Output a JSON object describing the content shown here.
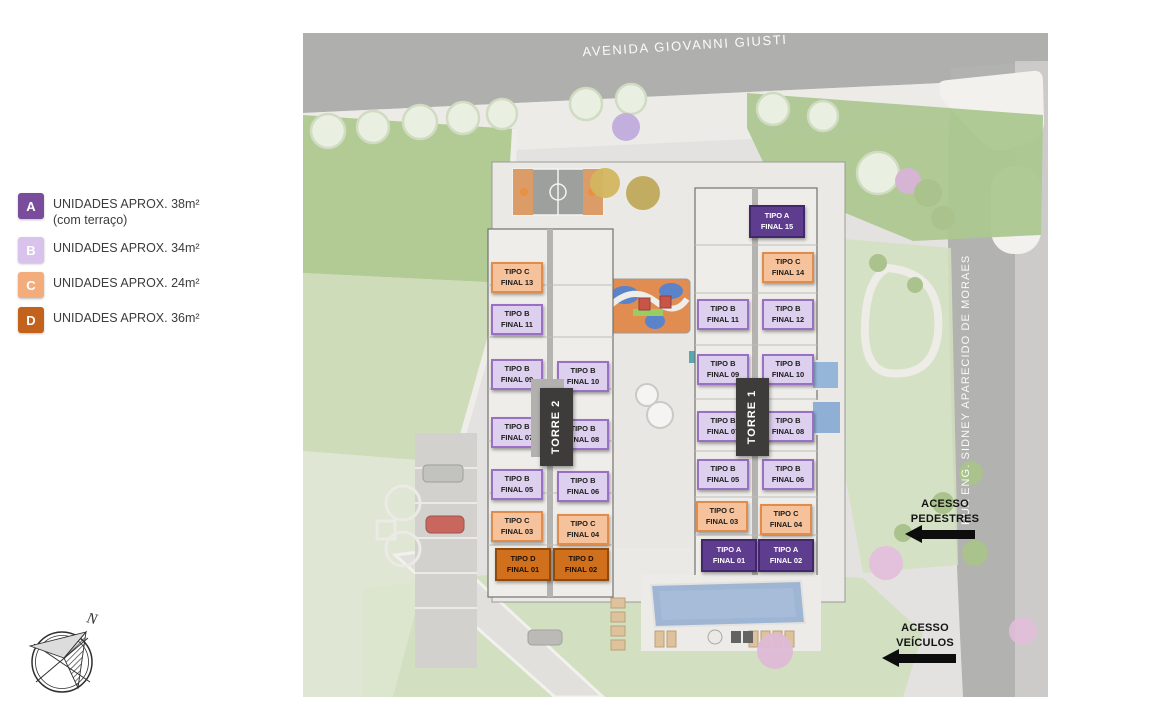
{
  "legend": {
    "items": [
      {
        "code": "A",
        "label": "UNIDADES APROX. 38m²",
        "sublabel": "(com terraço)",
        "color": "#7a4d9c"
      },
      {
        "code": "B",
        "label": "UNIDADES APROX. 34m²",
        "sublabel": "",
        "color": "#d9c2ec"
      },
      {
        "code": "C",
        "label": "UNIDADES APROX. 24m²",
        "sublabel": "",
        "color": "#f3ad7d"
      },
      {
        "code": "D",
        "label": "UNIDADES APROX. 36m²",
        "sublabel": "",
        "color": "#c2621c"
      }
    ]
  },
  "streets": {
    "top": "AVENIDA GIOVANNI GIUSTI",
    "right": "RUA ENG. SIDNEY APARECIDO DE MORAES"
  },
  "towers": {
    "torre2": "TORRE 2",
    "torre1": "TORRE 1"
  },
  "access": {
    "pedestrians": {
      "line1": "ACESSO",
      "line2": "PEDESTRES"
    },
    "vehicles": {
      "line1": "ACESSO",
      "line2": "VEÍCULOS"
    }
  },
  "compass": {
    "north": "N"
  },
  "colors": {
    "type_a": "#5e3c8e",
    "type_b": "#ddd0ee",
    "type_c": "#f6c29b",
    "type_d": "#d0701d",
    "road": "#a6a6a4",
    "lawn": "#a6c383",
    "pool": "#8fa9cc",
    "banner": "#3d3c3b"
  },
  "units": [
    {
      "line1": "TIPO C",
      "line2": "FINAL 13"
    },
    {
      "line1": "TIPO B",
      "line2": "FINAL 11"
    },
    {
      "line1": "TIPO B",
      "line2": "FINAL 09"
    },
    {
      "line1": "TIPO B",
      "line2": "FINAL 07"
    },
    {
      "line1": "TIPO B",
      "line2": "FINAL 05"
    },
    {
      "line1": "TIPO C",
      "line2": "FINAL 03"
    },
    {
      "line1": "TIPO D",
      "line2": "FINAL 01"
    },
    {
      "line1": "TIPO B",
      "line2": "FINAL 10"
    },
    {
      "line1": "TIPO B",
      "line2": "FINAL 08"
    },
    {
      "line1": "TIPO B",
      "line2": "FINAL 06"
    },
    {
      "line1": "TIPO C",
      "line2": "FINAL 04"
    },
    {
      "line1": "TIPO D",
      "line2": "FINAL 02"
    },
    {
      "line1": "TIPO A",
      "line2": "FINAL 15"
    },
    {
      "line1": "TIPO C",
      "line2": "FINAL 14"
    },
    {
      "line1": "TIPO B",
      "line2": "FINAL 11"
    },
    {
      "line1": "TIPO B",
      "line2": "FINAL 12"
    },
    {
      "line1": "TIPO B",
      "line2": "FINAL 09"
    },
    {
      "line1": "TIPO B",
      "line2": "FINAL 10"
    },
    {
      "line1": "TIPO B",
      "line2": "FINAL 07"
    },
    {
      "line1": "TIPO B",
      "line2": "FINAL 08"
    },
    {
      "line1": "TIPO B",
      "line2": "FINAL 05"
    },
    {
      "line1": "TIPO B",
      "line2": "FINAL 06"
    },
    {
      "line1": "TIPO C",
      "line2": "FINAL 03"
    },
    {
      "line1": "TIPO C",
      "line2": "FINAL 04"
    },
    {
      "line1": "TIPO A",
      "line2": "FINAL 01"
    },
    {
      "line1": "TIPO A",
      "line2": "FINAL 02"
    }
  ]
}
